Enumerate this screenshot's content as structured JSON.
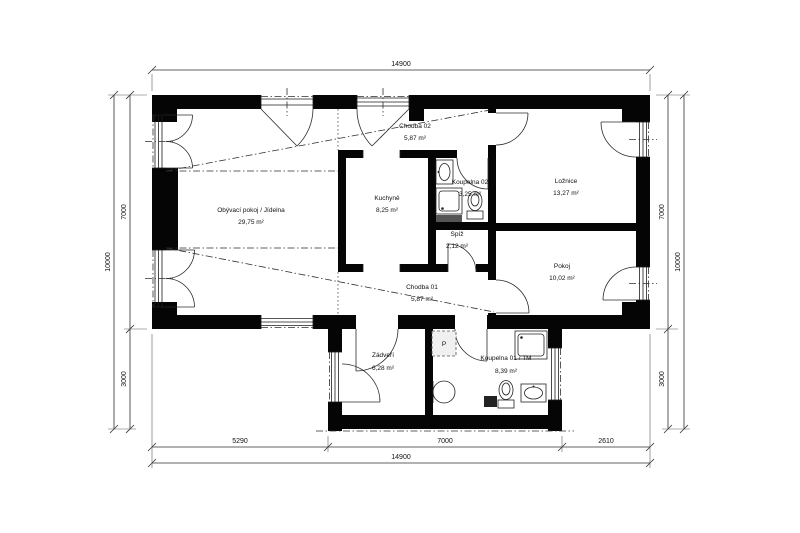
{
  "rooms": [
    {
      "name": "Obývací pokoj / Jídelna",
      "area": "29,75 m²"
    },
    {
      "name": "Kuchyně",
      "area": "8,25 m²"
    },
    {
      "name": "Chodba 02",
      "area": "5,87 m²"
    },
    {
      "name": "Koupelna 02",
      "area": "3,25 m²"
    },
    {
      "name": "Spíž",
      "area": "2,12 m²"
    },
    {
      "name": "Ložnice",
      "area": "13,27 m²"
    },
    {
      "name": "Pokoj",
      "area": "10,02 m²"
    },
    {
      "name": "Chodba 01",
      "area": "5,87 m²"
    },
    {
      "name": "Zádveří",
      "area": "6,28 m²"
    },
    {
      "name": "Koupelna 01 / TM",
      "area": "8,39 m²"
    }
  ],
  "symbols": {
    "washer": "P"
  },
  "dimensions": {
    "top_total": "14900",
    "bottom_segments": [
      "5290",
      "7000",
      "2610"
    ],
    "bottom_total": "14900",
    "left": {
      "inner_top": "7000",
      "inner_bottom": "3000",
      "outer": "10000"
    },
    "right": {
      "inner_top": "7000",
      "inner_bottom": "3000",
      "outer": "10000"
    }
  },
  "colors": {
    "wall": "#050505",
    "background": "#ffffff",
    "line": "#2f2f2f"
  }
}
